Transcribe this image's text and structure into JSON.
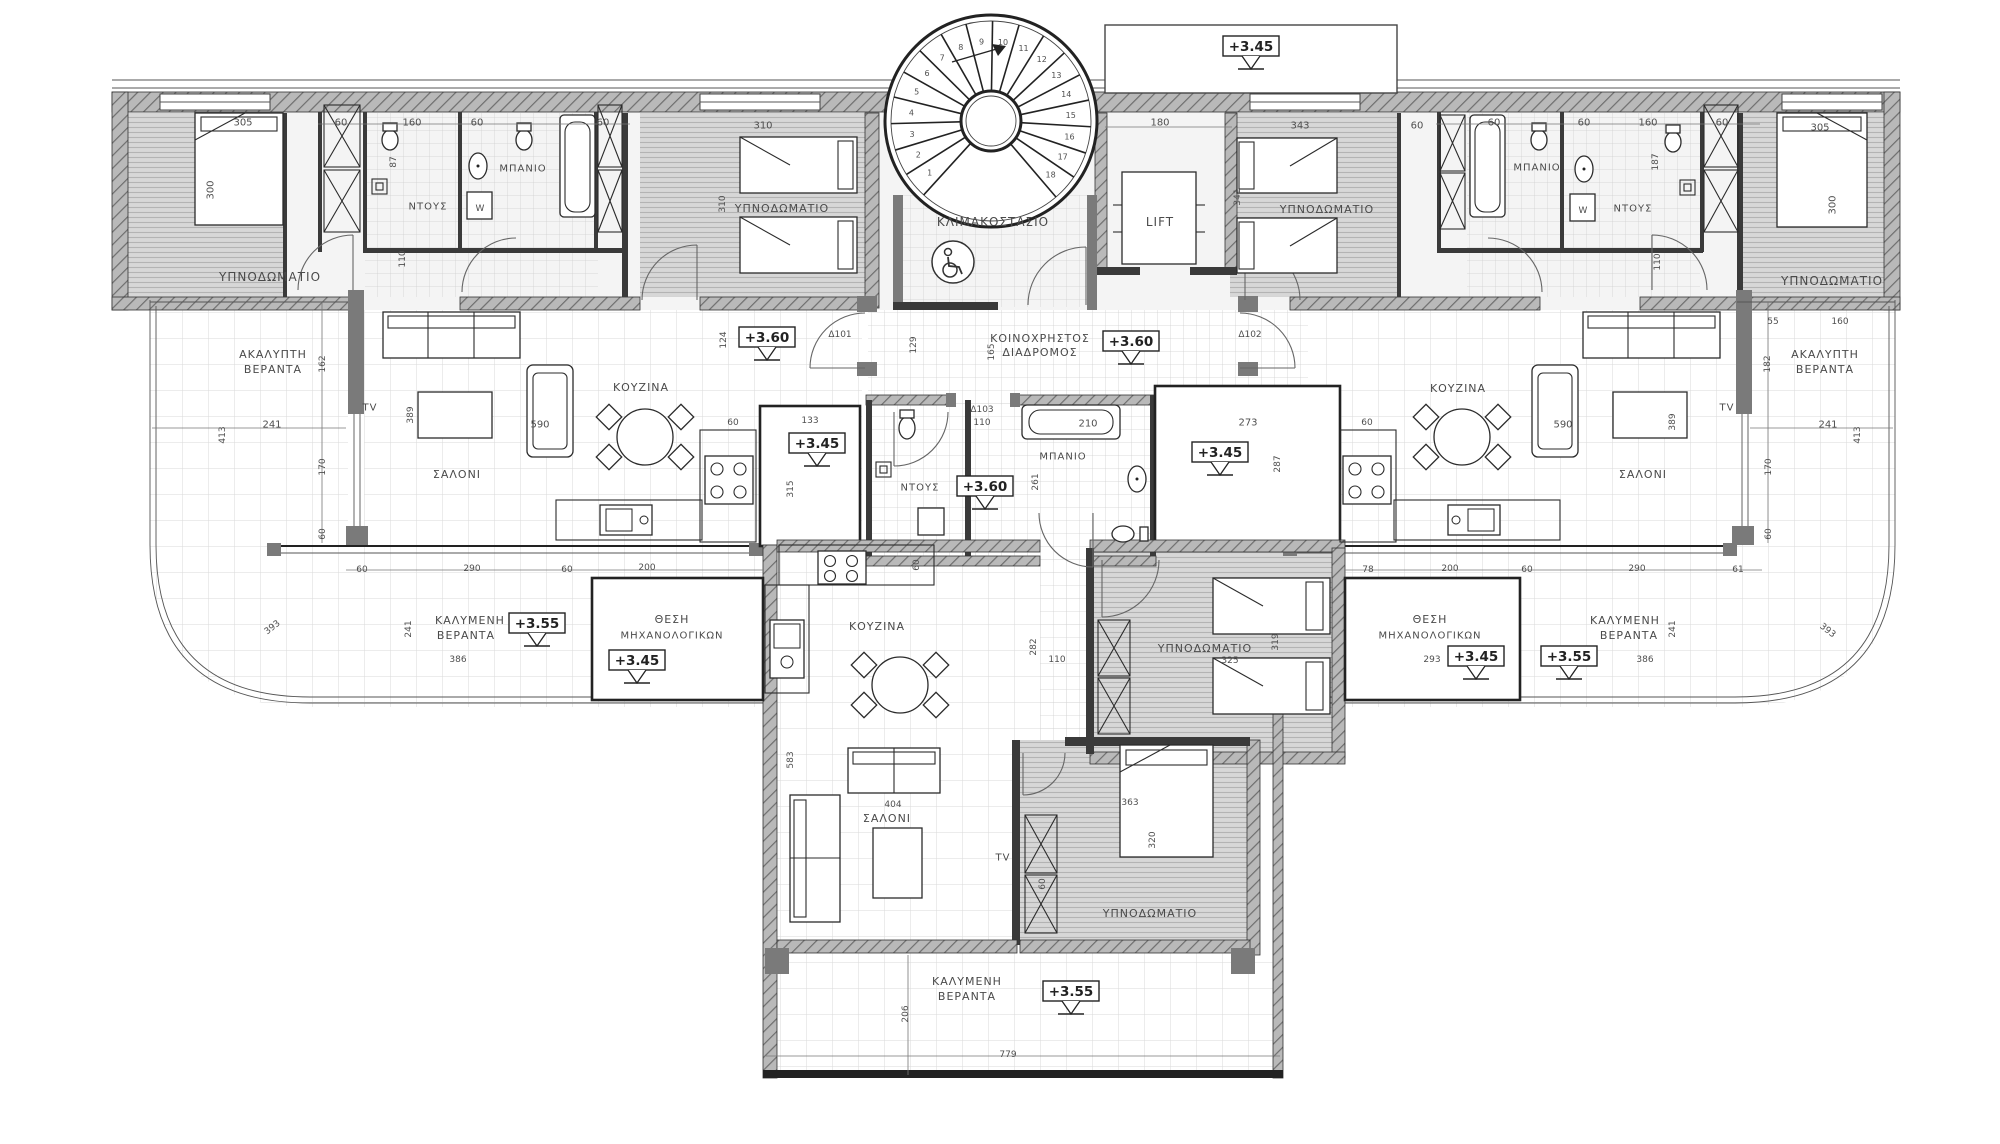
{
  "plan": {
    "areas": {
      "top_left_apartment": {
        "labels": [
          {
            "t": "305",
            "x": 243,
            "y": 122
          },
          {
            "t": "300",
            "x": 210,
            "y": 190,
            "rot": -90
          },
          {
            "t": "ΥΠΝΟΔΩΜΑΤΙΟ",
            "x": 270,
            "y": 277,
            "size": 12
          },
          {
            "t": "60",
            "x": 341,
            "y": 122
          },
          {
            "t": "87",
            "x": 393,
            "y": 162,
            "rot": -90,
            "size": 9
          },
          {
            "t": "160",
            "x": 412,
            "y": 122
          },
          {
            "t": "ΝΤΟΥΣ",
            "x": 428,
            "y": 206
          },
          {
            "t": "60",
            "x": 477,
            "y": 122
          },
          {
            "t": "ΜΠΑΝΙΟ",
            "x": 523,
            "y": 168
          },
          {
            "t": "W",
            "x": 480,
            "y": 208,
            "size": 9
          },
          {
            "t": "60",
            "x": 603,
            "y": 122
          },
          {
            "t": "110",
            "x": 402,
            "y": 259,
            "rot": -90,
            "size": 9
          },
          {
            "t": "310",
            "x": 763,
            "y": 125
          },
          {
            "t": "310",
            "x": 722,
            "y": 204,
            "rot": -90,
            "size": 9
          },
          {
            "t": "ΥΠΝΟΔΩΜΑΤΙΟ",
            "x": 782,
            "y": 208,
            "size": 11
          }
        ]
      },
      "core": {
        "labels": [
          {
            "t": "ΚΛΙΜΑΚΟΣΤΑΣΙΟ",
            "x": 993,
            "y": 222,
            "size": 12
          },
          {
            "t": "+3.45",
            "x": 1251,
            "y": 47,
            "box": true,
            "tri": true
          },
          {
            "t": "180",
            "x": 1160,
            "y": 122
          },
          {
            "t": "LIFT",
            "x": 1160,
            "y": 222,
            "size": 12
          },
          {
            "t": "129",
            "x": 913,
            "y": 345,
            "rot": -90,
            "size": 9
          },
          {
            "t": "165",
            "x": 991,
            "y": 352,
            "rot": -90,
            "size": 9
          },
          {
            "t": "ΚΟΙΝΟΧΡΗΣΤΟΣ",
            "x": 1040,
            "y": 338,
            "size": 11
          },
          {
            "t": "ΔΙΑΔΡΟΜΟΣ",
            "x": 1040,
            "y": 352,
            "size": 11
          },
          {
            "t": "+3.60",
            "x": 1131,
            "y": 342,
            "box": true,
            "tri": true
          },
          {
            "t": "Δ102",
            "x": 1250,
            "y": 334,
            "size": 9
          },
          {
            "t": "Δ101",
            "x": 840,
            "y": 334,
            "size": 9
          },
          {
            "t": "124",
            "x": 723,
            "y": 340,
            "rot": -90,
            "size": 9
          },
          {
            "t": "+3.60",
            "x": 767,
            "y": 338,
            "box": true,
            "tri": true
          },
          {
            "t": "Δ103",
            "x": 982,
            "y": 409,
            "size": 9
          },
          {
            "t": "110",
            "x": 982,
            "y": 422,
            "size": 9
          },
          {
            "t": "+3.60",
            "x": 985,
            "y": 487,
            "box": true,
            "tri": true
          },
          {
            "t": "ΝΤΟΥΣ",
            "x": 920,
            "y": 487,
            "size": 10
          },
          {
            "t": "210",
            "x": 1088,
            "y": 423
          },
          {
            "t": "ΜΠΑΝΙΟ",
            "x": 1063,
            "y": 456,
            "size": 10
          },
          {
            "t": "261",
            "x": 1035,
            "y": 482,
            "rot": -90,
            "size": 9
          },
          {
            "t": "60",
            "x": 916,
            "y": 565,
            "rot": -90,
            "size": 9
          },
          {
            "t": "273",
            "x": 1248,
            "y": 422
          },
          {
            "t": "+3.45",
            "x": 1220,
            "y": 453,
            "box": true,
            "tri": true
          },
          {
            "t": "287",
            "x": 1277,
            "y": 464,
            "rot": -90,
            "size": 9
          }
        ]
      },
      "top_right_apartment": {
        "labels": [
          {
            "t": "343",
            "x": 1300,
            "y": 125
          },
          {
            "t": "341",
            "x": 1237,
            "y": 197,
            "rot": -90,
            "size": 9
          },
          {
            "t": "ΥΠΝΟΔΩΜΑΤΙΟ",
            "x": 1327,
            "y": 209,
            "size": 11
          },
          {
            "t": "60",
            "x": 1417,
            "y": 125
          },
          {
            "t": "60",
            "x": 1494,
            "y": 122
          },
          {
            "t": "ΜΠΑΝΙΟ",
            "x": 1537,
            "y": 167
          },
          {
            "t": "60",
            "x": 1584,
            "y": 122
          },
          {
            "t": "W",
            "x": 1583,
            "y": 210,
            "size": 9
          },
          {
            "t": "ΝΤΟΥΣ",
            "x": 1633,
            "y": 208
          },
          {
            "t": "160",
            "x": 1648,
            "y": 122
          },
          {
            "t": "187",
            "x": 1655,
            "y": 162,
            "rot": -90,
            "size": 9
          },
          {
            "t": "60",
            "x": 1722,
            "y": 122
          },
          {
            "t": "305",
            "x": 1820,
            "y": 127
          },
          {
            "t": "300",
            "x": 1832,
            "y": 205,
            "rot": -90
          },
          {
            "t": "ΥΠΝΟΔΩΜΑΤΙΟ",
            "x": 1832,
            "y": 281,
            "size": 12
          },
          {
            "t": "110",
            "x": 1657,
            "y": 262,
            "rot": -90,
            "size": 9
          }
        ]
      },
      "left_apartment": {
        "labels": [
          {
            "t": "ΑΚΑΛΥΠΤΗ",
            "x": 273,
            "y": 354,
            "size": 11
          },
          {
            "t": "ΒΕΡΑΝΤΑ",
            "x": 273,
            "y": 369,
            "size": 11
          },
          {
            "t": "162",
            "x": 322,
            "y": 364,
            "rot": -90,
            "size": 9
          },
          {
            "t": "241",
            "x": 272,
            "y": 424
          },
          {
            "t": "413",
            "x": 222,
            "y": 435,
            "rot": -90,
            "size": 9
          },
          {
            "t": "170",
            "x": 322,
            "y": 467,
            "rot": -90,
            "size": 9
          },
          {
            "t": "60",
            "x": 322,
            "y": 534,
            "rot": -90,
            "size": 9
          },
          {
            "t": "TV",
            "x": 370,
            "y": 407,
            "size": 10
          },
          {
            "t": "389",
            "x": 410,
            "y": 415,
            "rot": -90,
            "size": 9
          },
          {
            "t": "590",
            "x": 540,
            "y": 424,
            "size": 10
          },
          {
            "t": "ΣΑΛΟΝΙ",
            "x": 457,
            "y": 474,
            "size": 11
          },
          {
            "t": "ΚΟΥΖΙΝΑ",
            "x": 641,
            "y": 387,
            "size": 11
          },
          {
            "t": "60",
            "x": 733,
            "y": 422,
            "size": 9
          },
          {
            "t": "133",
            "x": 810,
            "y": 420,
            "size": 9
          },
          {
            "t": "+3.45",
            "x": 817,
            "y": 444,
            "box": true,
            "tri": true
          },
          {
            "t": "315",
            "x": 790,
            "y": 489,
            "rot": -90,
            "size": 9
          }
        ]
      },
      "right_apartment": {
        "labels": [
          {
            "t": "60",
            "x": 1367,
            "y": 422,
            "size": 9
          },
          {
            "t": "ΚΟΥΖΙΝΑ",
            "x": 1458,
            "y": 388,
            "size": 11
          },
          {
            "t": "590",
            "x": 1563,
            "y": 424,
            "size": 10
          },
          {
            "t": "389",
            "x": 1672,
            "y": 422,
            "rot": -90,
            "size": 9
          },
          {
            "t": "ΣΑΛΟΝΙ",
            "x": 1643,
            "y": 474,
            "size": 11
          },
          {
            "t": "TV",
            "x": 1727,
            "y": 407,
            "size": 10
          },
          {
            "t": "55",
            "x": 1773,
            "y": 321,
            "size": 9
          },
          {
            "t": "160",
            "x": 1840,
            "y": 321,
            "size": 9
          },
          {
            "t": "ΑΚΑΛΥΠΤΗ",
            "x": 1825,
            "y": 354,
            "size": 11
          },
          {
            "t": "ΒΕΡΑΝΤΑ",
            "x": 1825,
            "y": 369,
            "size": 11
          },
          {
            "t": "182",
            "x": 1767,
            "y": 364,
            "rot": -90,
            "size": 9
          },
          {
            "t": "241",
            "x": 1828,
            "y": 424
          },
          {
            "t": "413",
            "x": 1857,
            "y": 435,
            "rot": -90,
            "size": 9
          },
          {
            "t": "170",
            "x": 1768,
            "y": 467,
            "rot": -90,
            "size": 9
          },
          {
            "t": "60",
            "x": 1768,
            "y": 534,
            "rot": -90,
            "size": 9
          }
        ]
      },
      "left_wing_terrace": {
        "labels": [
          {
            "t": "60",
            "x": 362,
            "y": 569,
            "size": 9
          },
          {
            "t": "290",
            "x": 472,
            "y": 568,
            "size": 9
          },
          {
            "t": "60",
            "x": 567,
            "y": 569,
            "size": 9
          },
          {
            "t": "200",
            "x": 647,
            "y": 567,
            "size": 9
          },
          {
            "t": "393",
            "x": 272,
            "y": 627,
            "rot": -38,
            "size": 9
          },
          {
            "t": "241",
            "x": 408,
            "y": 629,
            "rot": -90,
            "size": 9
          },
          {
            "t": "ΚΑΛΥΜΕΝΗ",
            "x": 470,
            "y": 620,
            "size": 11
          },
          {
            "t": "ΒΕΡΑΝΤΑ",
            "x": 466,
            "y": 635,
            "size": 11
          },
          {
            "t": "+3.55",
            "x": 537,
            "y": 624,
            "box": true,
            "tri": true
          },
          {
            "t": "386",
            "x": 458,
            "y": 659,
            "size": 9
          },
          {
            "t": "ΘΕΣΗ",
            "x": 672,
            "y": 619,
            "size": 11
          },
          {
            "t": "ΜΗΧΑΝΟΛΟΓΙΚΩΝ",
            "x": 672,
            "y": 635,
            "size": 10
          },
          {
            "t": "+3.45",
            "x": 637,
            "y": 661,
            "box": true,
            "tri": true
          }
        ]
      },
      "right_wing_terrace": {
        "labels": [
          {
            "t": "78",
            "x": 1368,
            "y": 569,
            "size": 9
          },
          {
            "t": "200",
            "x": 1450,
            "y": 568,
            "size": 9
          },
          {
            "t": "60",
            "x": 1527,
            "y": 569,
            "size": 9
          },
          {
            "t": "290",
            "x": 1637,
            "y": 568,
            "size": 9
          },
          {
            "t": "61",
            "x": 1738,
            "y": 569,
            "size": 9
          },
          {
            "t": "ΘΕΣΗ",
            "x": 1430,
            "y": 619,
            "size": 11
          },
          {
            "t": "ΜΗΧΑΝΟΛΟΓΙΚΩΝ",
            "x": 1430,
            "y": 635,
            "size": 10
          },
          {
            "t": "293",
            "x": 1432,
            "y": 659,
            "size": 9
          },
          {
            "t": "+3.45",
            "x": 1476,
            "y": 657,
            "box": true,
            "tri": true
          },
          {
            "t": "+3.55",
            "x": 1569,
            "y": 657,
            "box": true,
            "tri": true
          },
          {
            "t": "ΚΑΛΥΜΕΝΗ",
            "x": 1625,
            "y": 620,
            "size": 11
          },
          {
            "t": "ΒΕΡΑΝΤΑ",
            "x": 1629,
            "y": 635,
            "size": 11
          },
          {
            "t": "386",
            "x": 1645,
            "y": 659,
            "size": 9
          },
          {
            "t": "241",
            "x": 1672,
            "y": 629,
            "rot": -90,
            "size": 9
          },
          {
            "t": "393",
            "x": 1828,
            "y": 630,
            "rot": 38,
            "size": 9
          }
        ]
      },
      "bottom_apartment": {
        "labels": [
          {
            "t": "583",
            "x": 790,
            "y": 760,
            "rot": -90,
            "size": 9
          },
          {
            "t": "ΚΟΥΖΙΝΑ",
            "x": 877,
            "y": 626,
            "size": 11
          },
          {
            "t": "282",
            "x": 1033,
            "y": 647,
            "rot": -90,
            "size": 9
          },
          {
            "t": "110",
            "x": 1057,
            "y": 659,
            "size": 9
          },
          {
            "t": "ΥΠΝΟΔΩΜΑΤΙΟ",
            "x": 1205,
            "y": 648,
            "size": 11
          },
          {
            "t": "325",
            "x": 1230,
            "y": 660,
            "size": 9
          },
          {
            "t": "319",
            "x": 1275,
            "y": 642,
            "rot": -90,
            "size": 9
          },
          {
            "t": "404",
            "x": 893,
            "y": 804,
            "size": 9
          },
          {
            "t": "ΣΑΛΟΝΙ",
            "x": 887,
            "y": 818,
            "size": 11
          },
          {
            "t": "TV",
            "x": 1003,
            "y": 857,
            "size": 10
          },
          {
            "t": "60",
            "x": 1042,
            "y": 884,
            "rot": -90,
            "size": 9
          },
          {
            "t": "363",
            "x": 1130,
            "y": 802,
            "size": 9
          },
          {
            "t": "320",
            "x": 1152,
            "y": 840,
            "rot": -90,
            "size": 9
          },
          {
            "t": "ΥΠΝΟΔΩΜΑΤΙΟ",
            "x": 1150,
            "y": 913,
            "size": 11
          },
          {
            "t": "ΚΑΛΥΜΕΝΗ",
            "x": 967,
            "y": 981,
            "size": 11
          },
          {
            "t": "ΒΕΡΑΝΤΑ",
            "x": 967,
            "y": 996,
            "size": 11
          },
          {
            "t": "+3.55",
            "x": 1071,
            "y": 992,
            "box": true,
            "tri": true
          },
          {
            "t": "206",
            "x": 905,
            "y": 1014,
            "rot": -90,
            "size": 9
          },
          {
            "t": "779",
            "x": 1008,
            "y": 1054,
            "size": 9
          }
        ]
      }
    },
    "staircase": {
      "steps": [
        1,
        2,
        3,
        4,
        5,
        6,
        7,
        8,
        9,
        10,
        11,
        12,
        13,
        14,
        15,
        16,
        17,
        18
      ]
    }
  },
  "colors": {
    "wall_hatch": "#b9b9b9",
    "wall_line": "#333333",
    "text": "#3c3c3c",
    "bedroom_floor": "#d7d7d7",
    "tile_line": "#d0d0d0"
  }
}
